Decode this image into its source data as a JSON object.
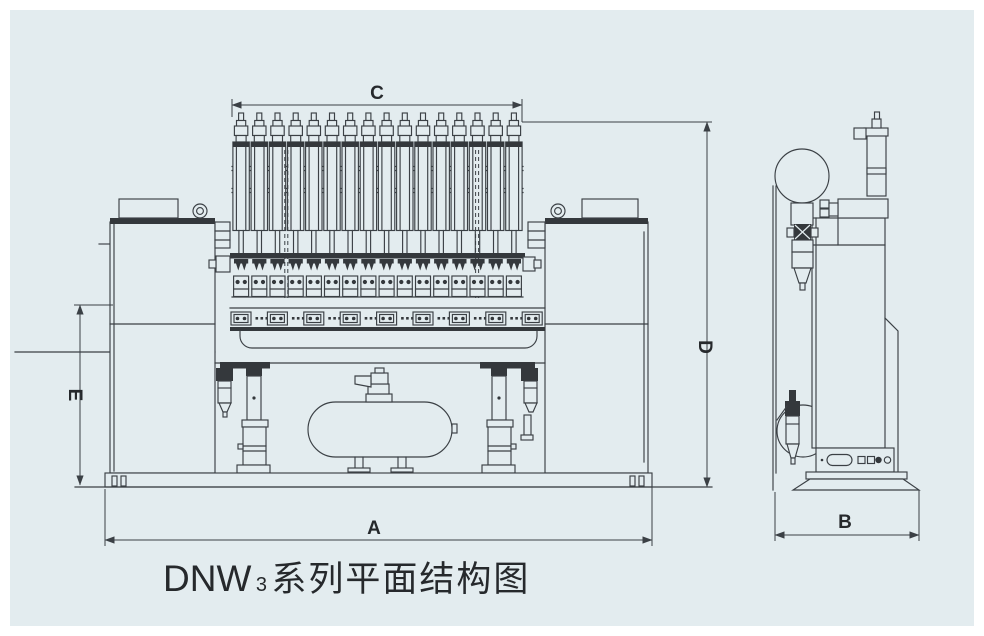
{
  "caption": {
    "model": "DNW",
    "model_subscript": "3",
    "series_text": "系列平面结构图"
  },
  "dimensions": {
    "a": "A",
    "b": "B",
    "c": "C",
    "d": "D",
    "e": "E"
  },
  "colors": {
    "page": "#ffffff",
    "panel": "#e3ecef",
    "line": "#3b4045",
    "dark": "#34383c",
    "text": "#26292c"
  }
}
